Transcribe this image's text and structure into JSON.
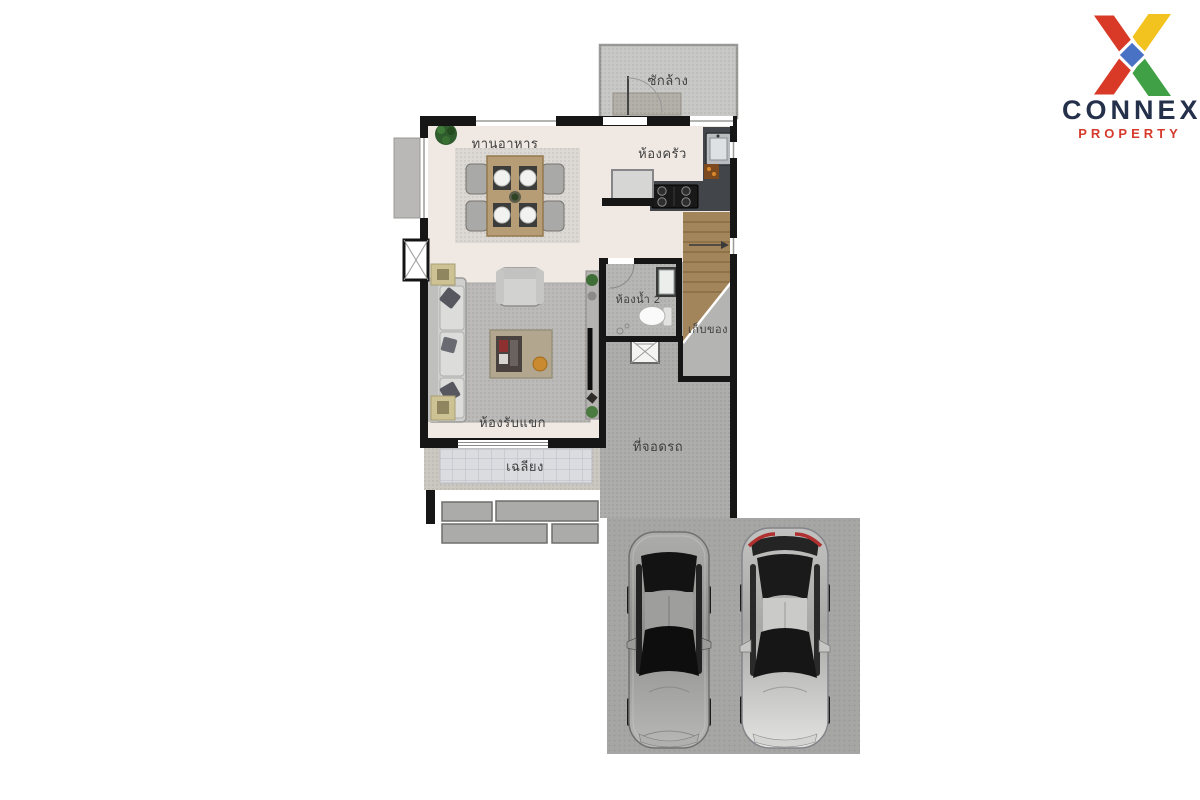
{
  "logo": {
    "brand": "CONNEX",
    "tagline": "PROPERTY",
    "brand_color": "#25304b",
    "tagline_color": "#d63a2c",
    "x_colors": {
      "red": "#d93a28",
      "yellow": "#f2c21e",
      "green": "#3fa045",
      "blue": "#4a72c4"
    }
  },
  "floorplan": {
    "rooms": {
      "laundry": {
        "label": "ซักล้าง"
      },
      "dining": {
        "label": "ทานอาหาร"
      },
      "kitchen": {
        "label": "ห้องครัว"
      },
      "bathroom2": {
        "label": "ห้องน้ำ 2"
      },
      "storage": {
        "label": "เก็บของ"
      },
      "living": {
        "label": "ห้องรับแขก"
      },
      "porch": {
        "label": "เฉลียง"
      },
      "parking": {
        "label": "ที่จอดรถ"
      }
    },
    "colors": {
      "wall": "#161616",
      "floor": "#f0e9e3",
      "grey_room": "#b6b6b4",
      "parking": "#adadab",
      "stair_wood": "#a3855b",
      "counter": "#42464a",
      "porch_tile": "#dadce0"
    },
    "cars": [
      {
        "name": "grey-sedan",
        "body_color": "#9e9e9c"
      },
      {
        "name": "silver-sedan",
        "body_color": "#d0d0ce"
      }
    ]
  }
}
